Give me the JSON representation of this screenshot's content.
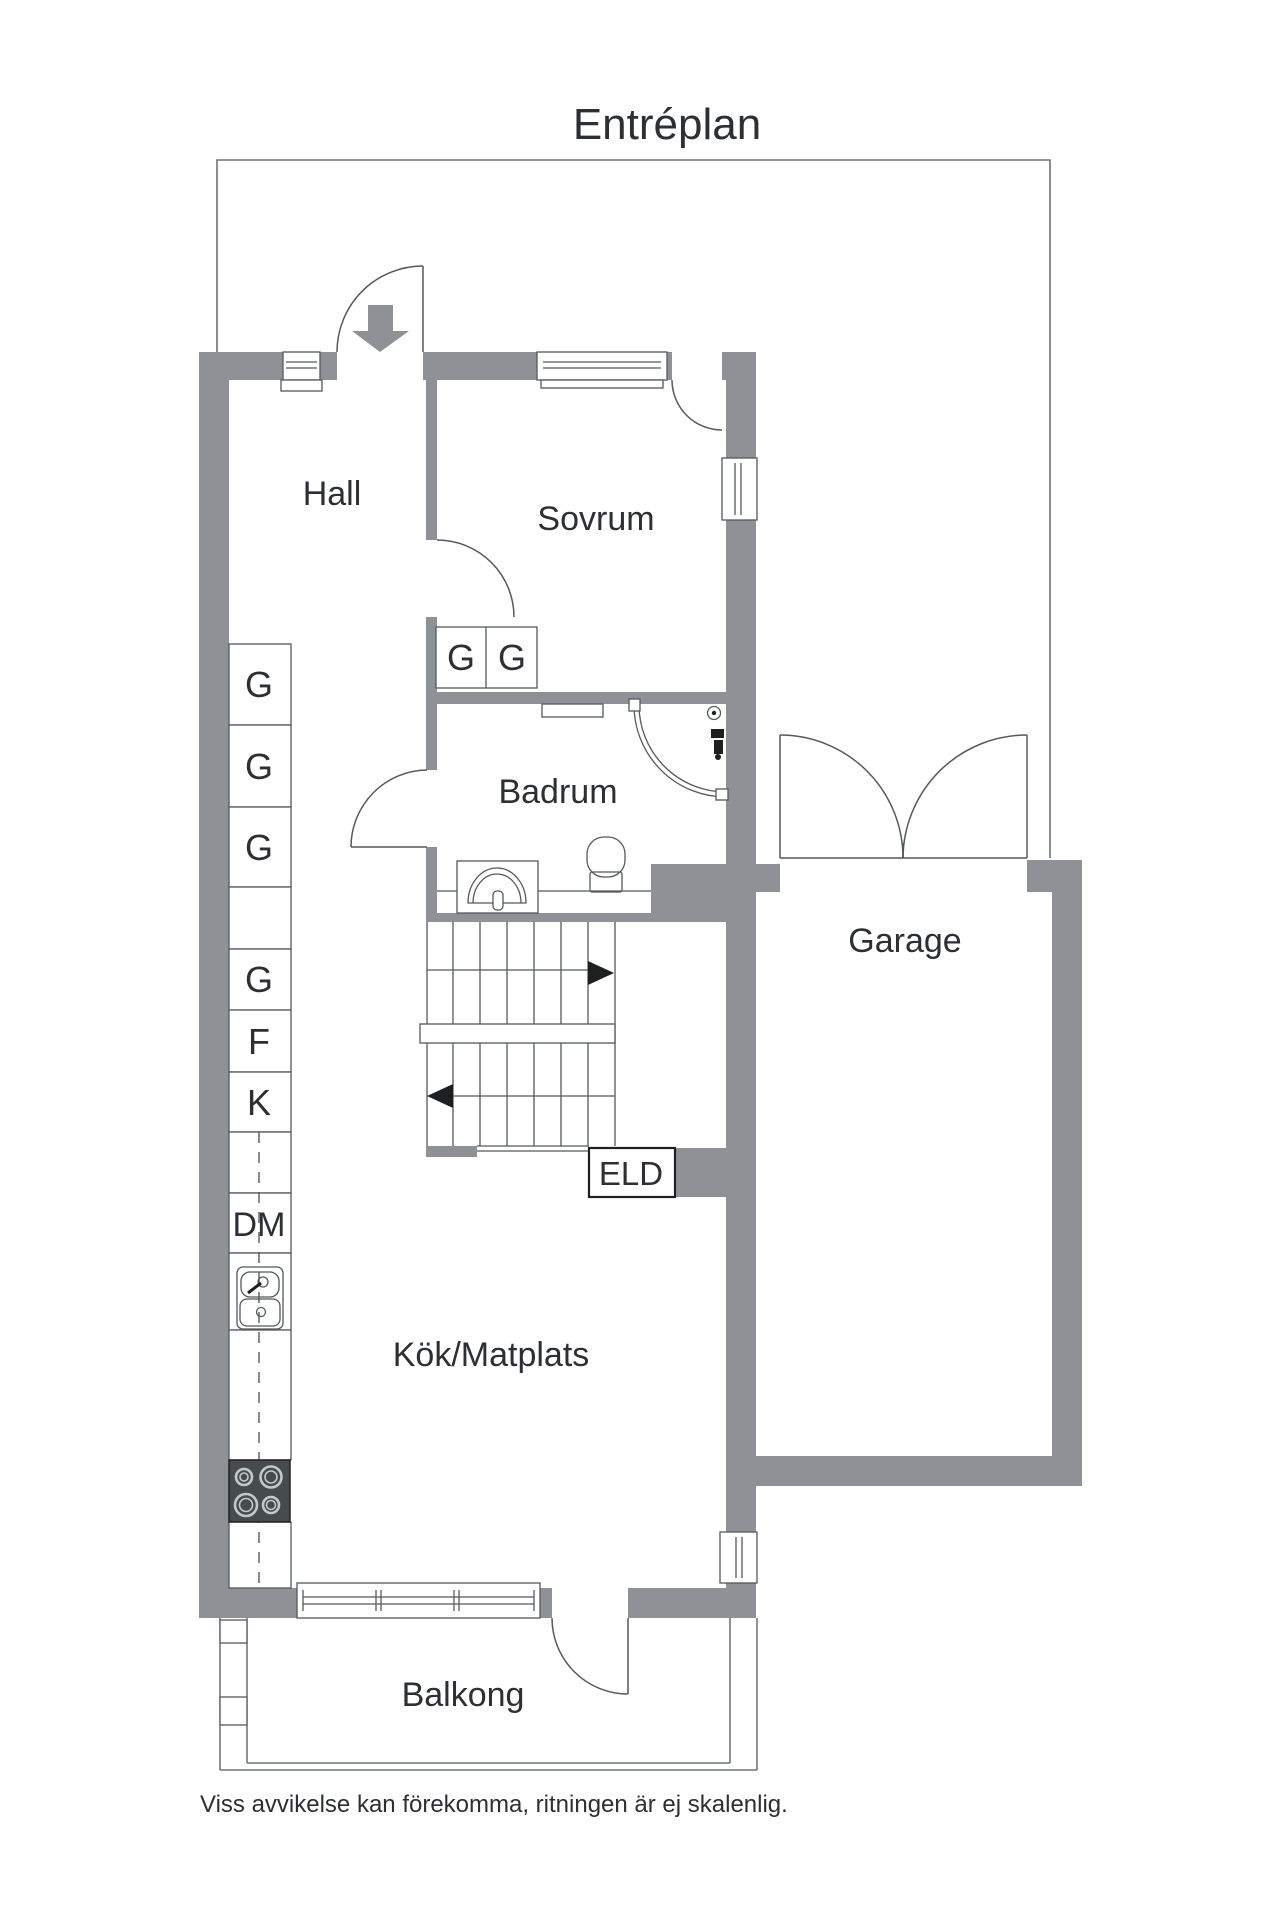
{
  "title": "Entréplan",
  "rooms": {
    "hall": "Hall",
    "sovrum": "Sovrum",
    "badrum": "Badrum",
    "garage": "Garage",
    "kok": "Kök/Matplats",
    "balkong": "Balkong"
  },
  "fixtures": {
    "eld": "ELD"
  },
  "closets": {
    "left_column": [
      {
        "label": "G"
      },
      {
        "label": "G"
      },
      {
        "label": "G"
      },
      {
        "label": "G"
      },
      {
        "label": "F"
      },
      {
        "label": "K"
      },
      {
        "label": "DM"
      }
    ],
    "sovrum": [
      {
        "label": "G"
      },
      {
        "label": "G"
      }
    ]
  },
  "footer": "Viss avvikelse kan förekomma, ritningen är ej skalenlig.",
  "colors": {
    "background": "#ffffff",
    "wall": "#8e9296",
    "line": "#3f4347",
    "outline": "#6e7276",
    "text": "#2c2f33",
    "stove": "#474b4e",
    "arrow_black": "#1d1f21"
  }
}
